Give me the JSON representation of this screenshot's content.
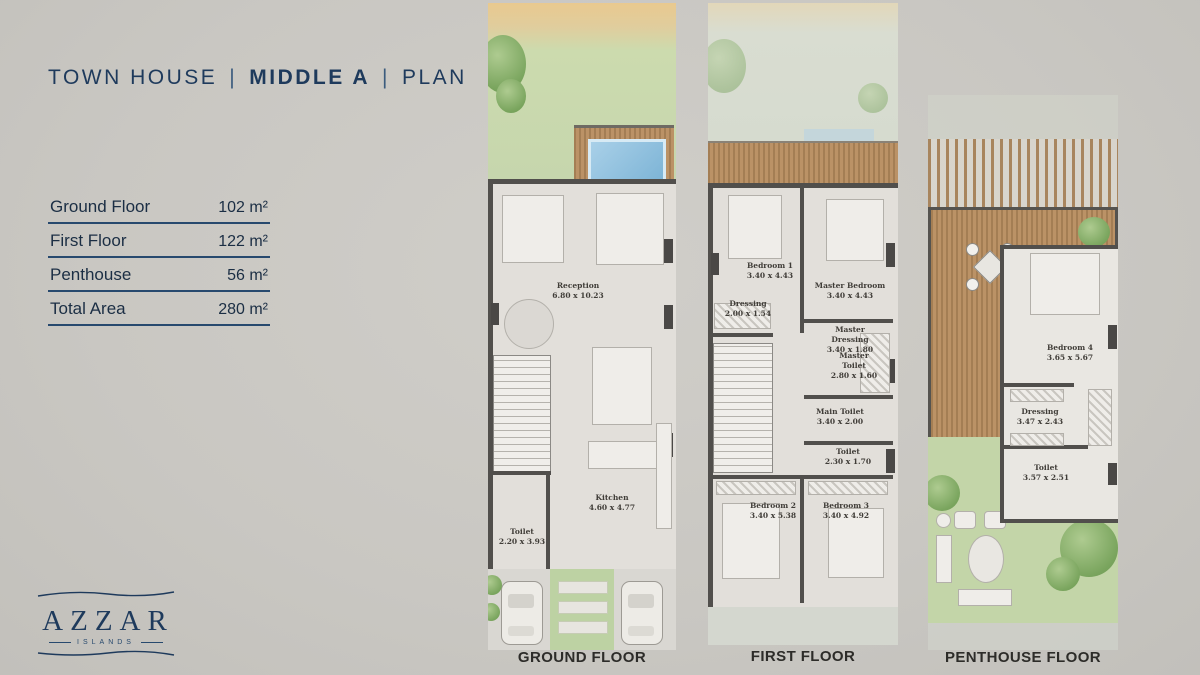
{
  "title": {
    "product": "TOWN HOUSE",
    "variant": "MIDDLE A",
    "suffix": "PLAN",
    "sep": "|"
  },
  "area_table": {
    "rows": [
      {
        "label": "Ground Floor",
        "value": "102 m²"
      },
      {
        "label": "First Floor",
        "value": "122 m²"
      },
      {
        "label": "Penthouse",
        "value": "56 m²"
      },
      {
        "label": "Total Area",
        "value": "280 m²"
      }
    ]
  },
  "logo": {
    "brand": "AZZAR",
    "sub": "ISLANDS"
  },
  "plans": [
    {
      "label": "GROUND FLOOR",
      "rooms": [
        {
          "name": "Reception",
          "dims": "6.80 x 10.23"
        },
        {
          "name": "Kitchen",
          "dims": "4.60 x 4.77"
        },
        {
          "name": "Toilet",
          "dims": "2.20 x 3.93"
        }
      ]
    },
    {
      "label": "FIRST FLOOR",
      "rooms": [
        {
          "name": "Bedroom 1",
          "dims": "3.40 x 4.43"
        },
        {
          "name": "Master Bedroom",
          "dims": "3.40 x 4.43"
        },
        {
          "name": "Dressing",
          "dims": "2.00 x 1.54"
        },
        {
          "name": "Master Dressing",
          "dims": "3.40 x 1.80"
        },
        {
          "name": "Master Toilet",
          "dims": "2.80 x 1.60"
        },
        {
          "name": "Main Toilet",
          "dims": "3.40 x 2.00"
        },
        {
          "name": "Toilet",
          "dims": "2.30 x 1.70"
        },
        {
          "name": "Bedroom 2",
          "dims": "3.40 x 5.38"
        },
        {
          "name": "Bedroom 3",
          "dims": "3.40 x 4.92"
        }
      ]
    },
    {
      "label": "PENTHOUSE FLOOR",
      "rooms": [
        {
          "name": "Bedroom 4",
          "dims": "3.65 x 5.67"
        },
        {
          "name": "Dressing",
          "dims": "3.47 x 2.43"
        },
        {
          "name": "Toilet",
          "dims": "3.57 x 2.51"
        }
      ]
    }
  ],
  "colors": {
    "navy": "#1e3a5c",
    "wall": "#514f4c",
    "wood": "#b08a5c",
    "pool": "#8ec1de",
    "garden": "#c6d6ad",
    "sand": "#e8c795"
  }
}
